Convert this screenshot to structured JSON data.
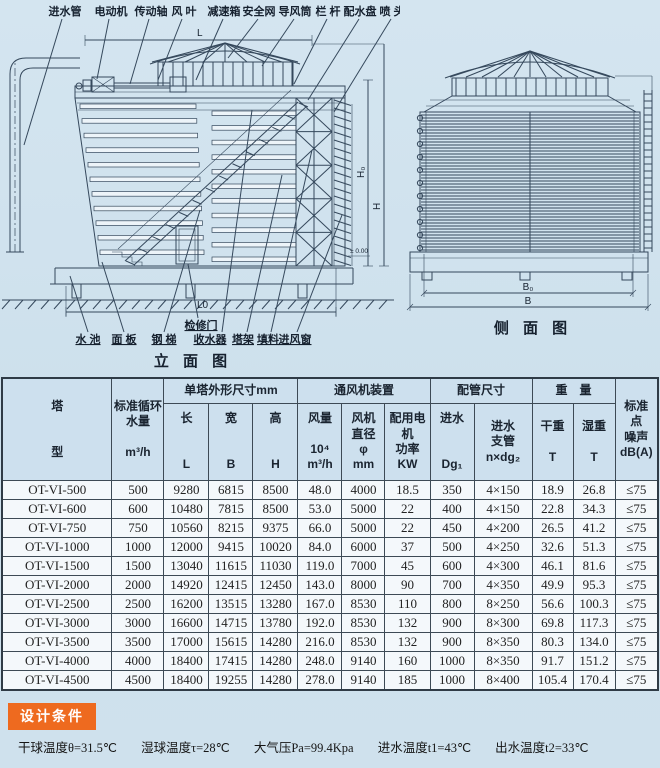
{
  "colors": {
    "badge_bg": "#ee6a1f",
    "header_bg": "#cde0ee",
    "page_bg": "#cfe1ed"
  },
  "elevation": {
    "caption": "立 面 图",
    "top_labels": [
      "进水管",
      "电动机",
      "传动轴",
      "风 叶",
      "减速箱",
      "安全网",
      "导风筒",
      "栏 杆",
      "配水盘",
      "喷 头"
    ],
    "bottom_labels": [
      "水 池",
      "面 板",
      "钢 梯",
      "检修门",
      "收水器",
      "塔架",
      "填料",
      "进风窗"
    ],
    "dims": {
      "L": "L",
      "L0": "L0",
      "H0": "H₀",
      "H": "H",
      "level": "± 0.00"
    }
  },
  "side": {
    "caption": "侧 面 图",
    "dims": {
      "B0": "B₀",
      "B": "B"
    }
  },
  "table": {
    "header": {
      "type": "塔\n\n\n型",
      "flow": "标准循环\n水量\n\nm³/h",
      "dims_group": "单塔外形尺寸mm",
      "fan_group": "通风机装置",
      "pipe_group": "配管尺寸",
      "weight_group": "重　量",
      "noise": "标准\n点\n噪声\ndB(A)",
      "len": "长\n\n\nL",
      "wid": "宽\n\n\nB",
      "hgt": "高\n\n\nH",
      "airflow": "风量\n\n10⁴\nm³/h",
      "fandia": "风机\n直径\nφ\nmm",
      "power": "配用电\n机\n功率\nKW",
      "inlet": "进水\n\n\nDg₁",
      "branch": "进水\n支管\nn×dg₂",
      "dry": "干重\n\nT",
      "wet": "湿重\n\nT"
    },
    "rows": [
      [
        "OT-VI-500",
        "500",
        "9280",
        "6815",
        "8500",
        "48.0",
        "4000",
        "18.5",
        "350",
        "4×150",
        "18.9",
        "26.8",
        "≤75"
      ],
      [
        "OT-VI-600",
        "600",
        "10480",
        "7815",
        "8500",
        "53.0",
        "5000",
        "22",
        "400",
        "4×150",
        "22.8",
        "34.3",
        "≤75"
      ],
      [
        "OT-VI-750",
        "750",
        "10560",
        "8215",
        "9375",
        "66.0",
        "5000",
        "22",
        "450",
        "4×200",
        "26.5",
        "41.2",
        "≤75"
      ],
      [
        "OT-VI-1000",
        "1000",
        "12000",
        "9415",
        "10020",
        "84.0",
        "6000",
        "37",
        "500",
        "4×250",
        "32.6",
        "51.3",
        "≤75"
      ],
      [
        "OT-VI-1500",
        "1500",
        "13040",
        "11615",
        "11030",
        "119.0",
        "7000",
        "45",
        "600",
        "4×300",
        "46.1",
        "81.6",
        "≤75"
      ],
      [
        "OT-VI-2000",
        "2000",
        "14920",
        "12415",
        "12450",
        "143.0",
        "8000",
        "90",
        "700",
        "4×350",
        "49.9",
        "95.3",
        "≤75"
      ],
      [
        "OT-VI-2500",
        "2500",
        "16200",
        "13515",
        "13280",
        "167.0",
        "8530",
        "110",
        "800",
        "8×250",
        "56.6",
        "100.3",
        "≤75"
      ],
      [
        "OT-VI-3000",
        "3000",
        "16600",
        "14715",
        "13780",
        "192.0",
        "8530",
        "132",
        "900",
        "8×300",
        "69.8",
        "117.3",
        "≤75"
      ],
      [
        "OT-VI-3500",
        "3500",
        "17000",
        "15615",
        "14280",
        "216.0",
        "8530",
        "132",
        "900",
        "8×350",
        "80.3",
        "134.0",
        "≤75"
      ],
      [
        "OT-VI-4000",
        "4000",
        "18400",
        "17415",
        "14280",
        "248.0",
        "9140",
        "160",
        "1000",
        "8×350",
        "91.7",
        "151.2",
        "≤75"
      ],
      [
        "OT-VI-4500",
        "4500",
        "18400",
        "19255",
        "14280",
        "278.0",
        "9140",
        "185",
        "1000",
        "8×400",
        "105.4",
        "170.4",
        "≤75"
      ]
    ]
  },
  "footer": {
    "badge": "设计条件",
    "conditions": [
      "干球温度θ=31.5℃",
      "湿球温度τ=28℃",
      "大气压Pa=99.4Kpa",
      "进水温度t1=43℃",
      "出水温度t2=33℃"
    ]
  }
}
